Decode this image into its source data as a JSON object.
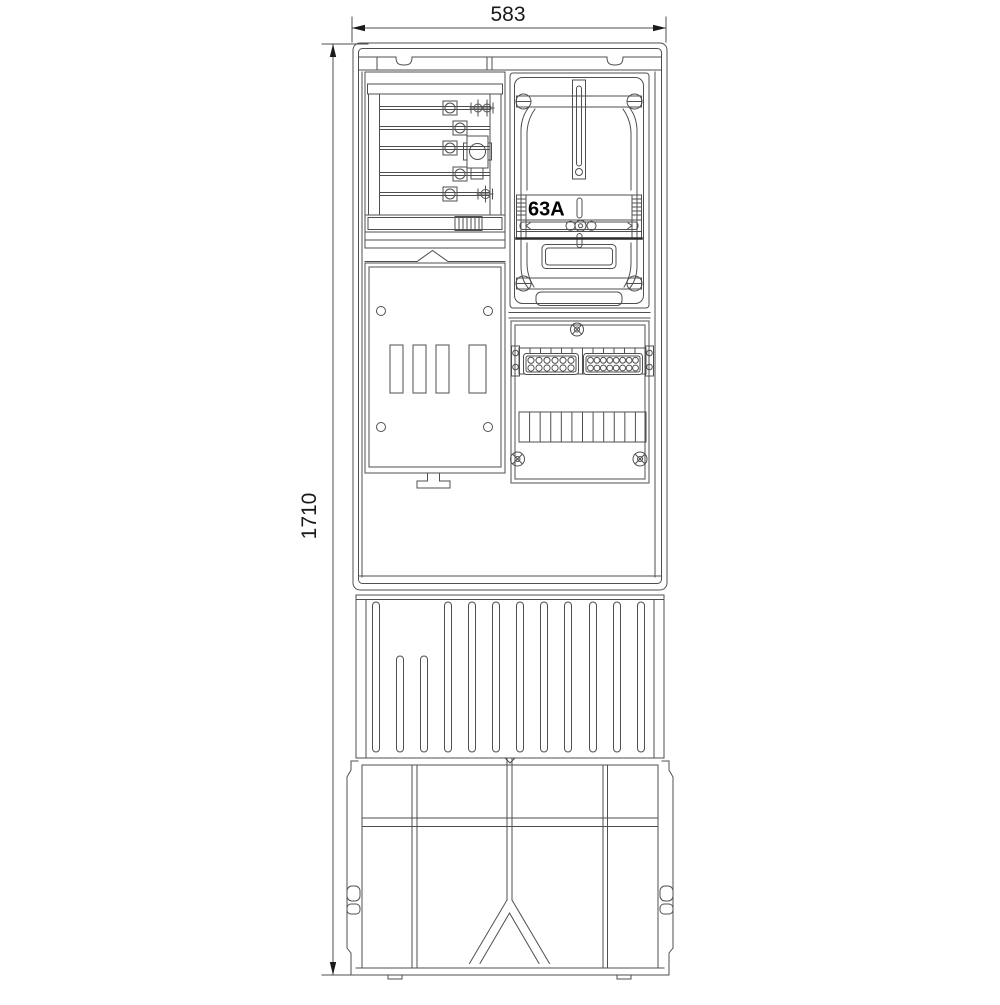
{
  "labels": {
    "width_dim": "583",
    "height_dim": "1710",
    "meter_rating": "63A"
  },
  "colors": {
    "background": "#ffffff",
    "line": "#4f4f4f",
    "text": "#1a1a1a",
    "rating_text": "#000000"
  },
  "drawing": {
    "fuse_rail_ys": [
      108,
      128,
      148,
      174,
      194
    ],
    "rib_tall_x": [
      376,
      448,
      472,
      496,
      520,
      544,
      568,
      593,
      617,
      641
    ],
    "rib_short_x": [
      400,
      424
    ],
    "rib_top": 602,
    "rib_short_top": 656,
    "rib_bottom": 752,
    "comb_cells": 12,
    "terminal_group1_cols": 6,
    "terminal_group2_cols": 8,
    "serration_tick_ys": [
      199,
      203,
      207,
      211,
      215
    ],
    "hatch_stripes": 6,
    "slot_xs": [
      390,
      413,
      436,
      469
    ],
    "slot_widths": [
      13,
      13,
      13,
      17
    ]
  }
}
